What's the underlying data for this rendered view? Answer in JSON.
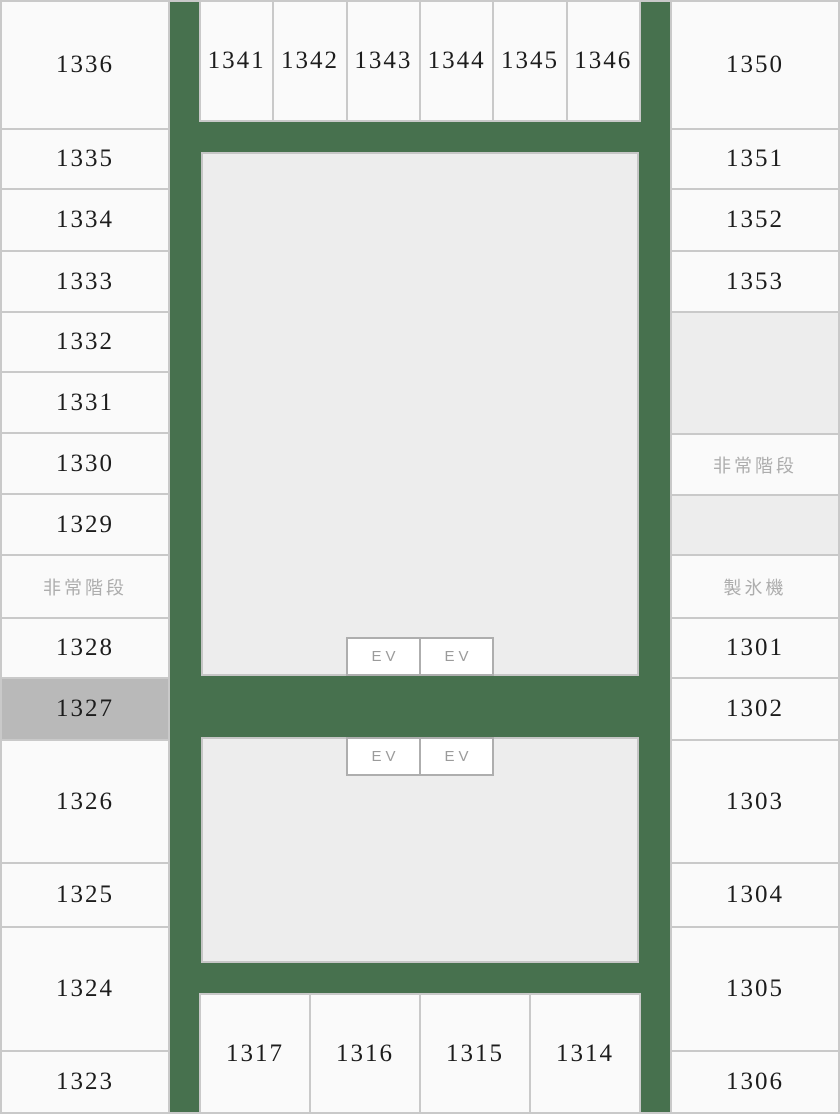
{
  "floor_map": {
    "selected_room": "1327",
    "ev_label": "EV",
    "colors": {
      "corridor_green": "#47714e",
      "room_bg": "#fafafa",
      "utility_block_bg": "#ededed",
      "grid_border": "#c9c9c9",
      "selected_room_bg": "#b9b9b9",
      "muted_label_text": "#adadad",
      "room_number_text": "#1c1c1c"
    },
    "left_column": {
      "cells": [
        {
          "label": "1336",
          "type": "room"
        },
        {
          "label": "1335",
          "type": "room"
        },
        {
          "label": "1334",
          "type": "room"
        },
        {
          "label": "1333",
          "type": "room"
        },
        {
          "label": "1332",
          "type": "room"
        },
        {
          "label": "1331",
          "type": "room"
        },
        {
          "label": "1330",
          "type": "room"
        },
        {
          "label": "1329",
          "type": "room"
        },
        {
          "label": "非常階段",
          "type": "emergency-stairs"
        },
        {
          "label": "1328",
          "type": "room"
        },
        {
          "label": "1327",
          "type": "room-selected"
        },
        {
          "label": "1326",
          "type": "room"
        },
        {
          "label": "1325",
          "type": "room"
        },
        {
          "label": "1324",
          "type": "room"
        },
        {
          "label": "1323",
          "type": "room"
        }
      ]
    },
    "right_column": {
      "cells": [
        {
          "label": "1350",
          "type": "room"
        },
        {
          "label": "1351",
          "type": "room"
        },
        {
          "label": "1352",
          "type": "room"
        },
        {
          "label": "1353",
          "type": "room"
        },
        {
          "label": "",
          "type": "empty-block"
        },
        {
          "label": "非常階段",
          "type": "emergency-stairs"
        },
        {
          "label": "",
          "type": "empty-block"
        },
        {
          "label": "製氷機",
          "type": "ice-machine"
        },
        {
          "label": "1301",
          "type": "room"
        },
        {
          "label": "1302",
          "type": "room"
        },
        {
          "label": "1303",
          "type": "room"
        },
        {
          "label": "1304",
          "type": "room"
        },
        {
          "label": "1305",
          "type": "room"
        },
        {
          "label": "1306",
          "type": "room"
        }
      ]
    },
    "top_row": {
      "cells": [
        {
          "label": "1341"
        },
        {
          "label": "1342"
        },
        {
          "label": "1343"
        },
        {
          "label": "1344"
        },
        {
          "label": "1345"
        },
        {
          "label": "1346"
        }
      ]
    },
    "bottom_row": {
      "cells": [
        {
          "label": "1317"
        },
        {
          "label": "1316"
        },
        {
          "label": "1315"
        },
        {
          "label": "1314"
        }
      ]
    }
  }
}
